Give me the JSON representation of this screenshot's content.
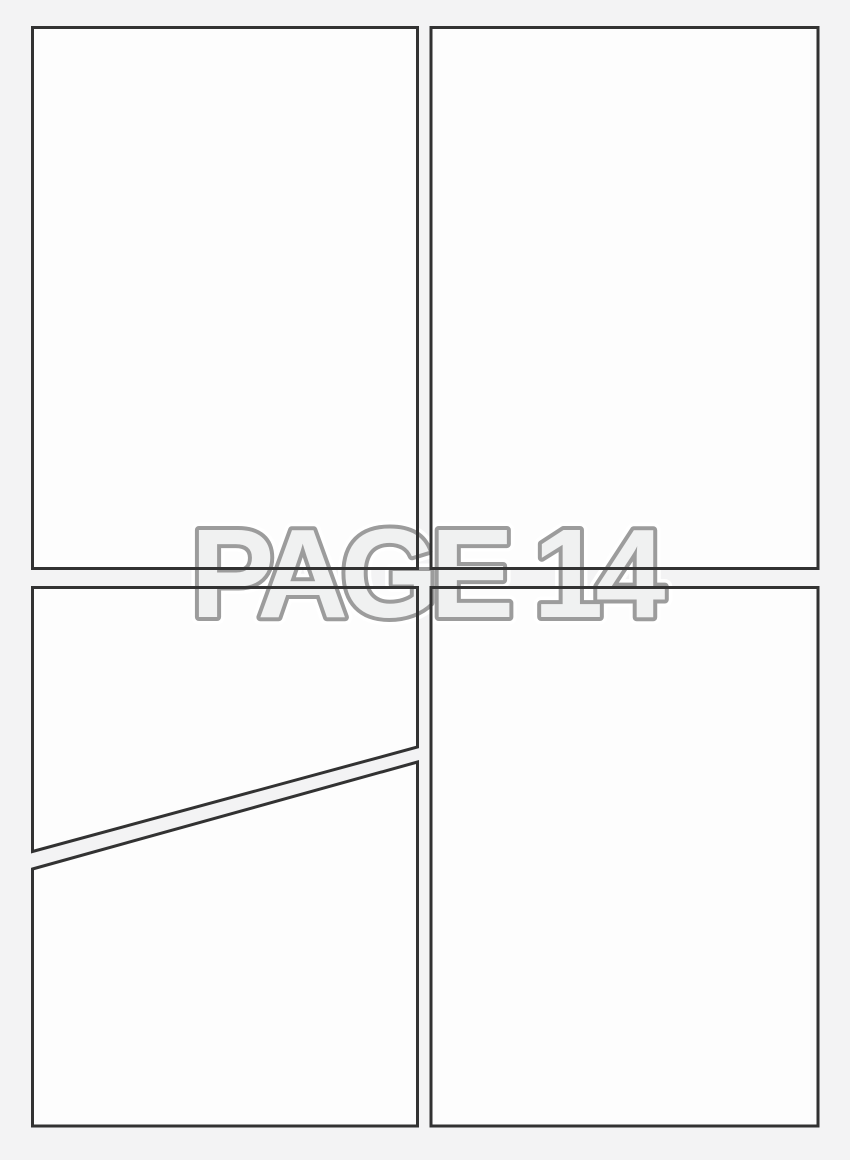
{
  "page_label": {
    "text": "PAGE 14"
  },
  "colors": {
    "background": "#f3f3f4",
    "panel_fill": "#fdfdfd",
    "panel_border": "#323232",
    "label_fill": "#f0f1f1",
    "label_outline": "#9c9c9c",
    "label_halo": "#ffffff"
  }
}
